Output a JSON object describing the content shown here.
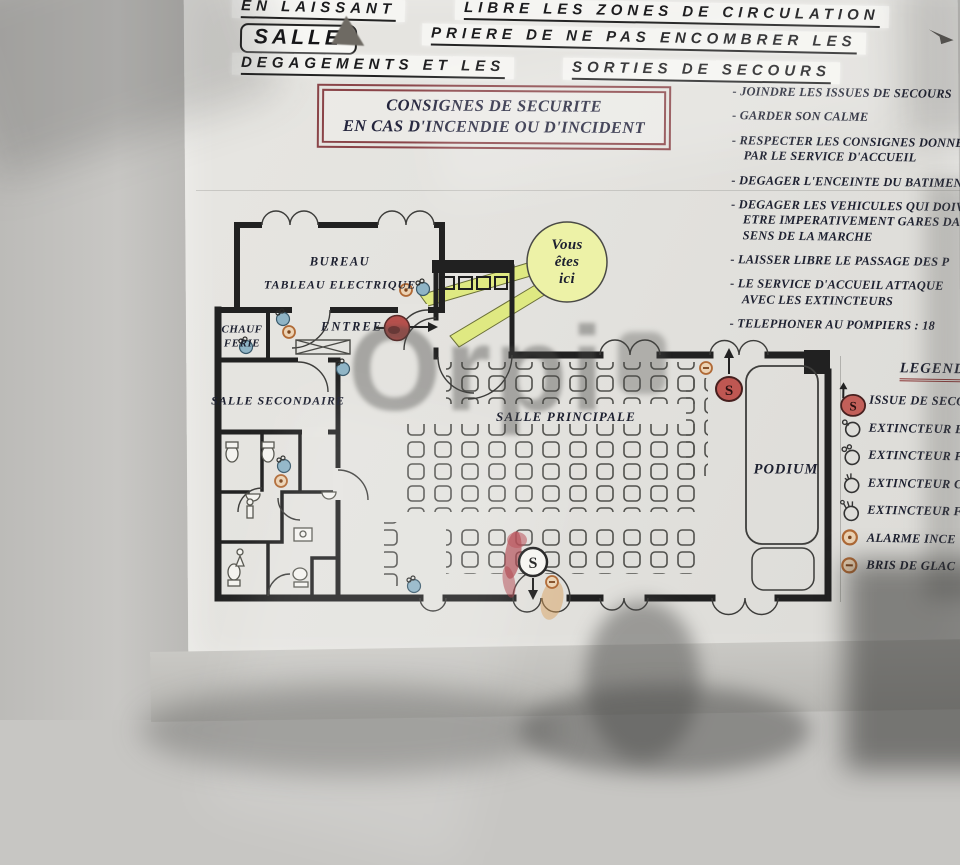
{
  "header": {
    "line1_left": "EN LAISSANT",
    "line1_right": "LIBRE LES ZONES DE CIRCULATION",
    "salle": "SALLE",
    "line2": "PRIERE DE NE PAS ENCOMBRER LES",
    "line3_left": "DEGAGEMENTS ET LES",
    "line3_right": "SORTIES DE SECOURS"
  },
  "title_box": {
    "line1": "CONSIGNES DE SECURITE",
    "line2": "EN CAS D'INCENDIE OU D'INCIDENT"
  },
  "instructions": [
    "- JOINDRE LES ISSUES DE SECOURS",
    "- GARDER SON CALME",
    "- RESPECTER LES CONSIGNES DONNEE\nPAR LE SERVICE D'ACCUEIL",
    "- DEGAGER L'ENCEINTE DU BATIMENT",
    "- DEGAGER LES VEHICULES QUI DOIV\nETRE IMPERATIVEMENT GARES DA\nSENS DE LA MARCHE",
    "- LAISSER LIBRE LE PASSAGE DES P",
    "- LE SERVICE D'ACCUEIL ATTAQUE\nAVEC LES EXTINCTEURS",
    "- TELEPHONER AU POMPIERS : 18"
  ],
  "plan": {
    "labels": {
      "bureau": "BUREAU",
      "tableau_electrique": "TABLEAU ELECTRIQUE",
      "chaufferie": "CHAUF\nFERIE",
      "entree": "ENTREE",
      "salle_secondaire": "SALLE SECONDAIRE",
      "salle_principale": "SALLE PRINCIPALE",
      "podium": "PODIUM"
    },
    "you_are_here": "Vous\nêtes\nici",
    "exit_letter": "S"
  },
  "legend": {
    "title": "LEGENDE",
    "items": [
      {
        "icon": "emergency-exit-icon",
        "label": "ISSUE DE SECOU"
      },
      {
        "icon": "extinguisher-water-icon",
        "label": "EXTINCTEUR EA"
      },
      {
        "icon": "extinguisher-powder-icon",
        "label": "EXTINCTEUR PO"
      },
      {
        "icon": "extinguisher-co2-icon",
        "label": "EXTINCTEUR C"
      },
      {
        "icon": "extinguisher-foam-icon",
        "label": "EXTINCTEUR F"
      },
      {
        "icon": "fire-alarm-icon",
        "label": "ALARME INCE"
      },
      {
        "icon": "break-glass-icon",
        "label": "BRIS DE GLAC"
      }
    ]
  },
  "watermark": "Orpi",
  "colors": {
    "poster": "#e4e3df",
    "ink": "#1d2030",
    "wall": "#212121",
    "title_border": "#8a4448",
    "exit_red": "#bf5752",
    "balloon_yellow": "#edf2a7",
    "icon_blue": "#8fb4c6",
    "icon_orange": "#b06a36",
    "stain_red": "#a93540"
  }
}
